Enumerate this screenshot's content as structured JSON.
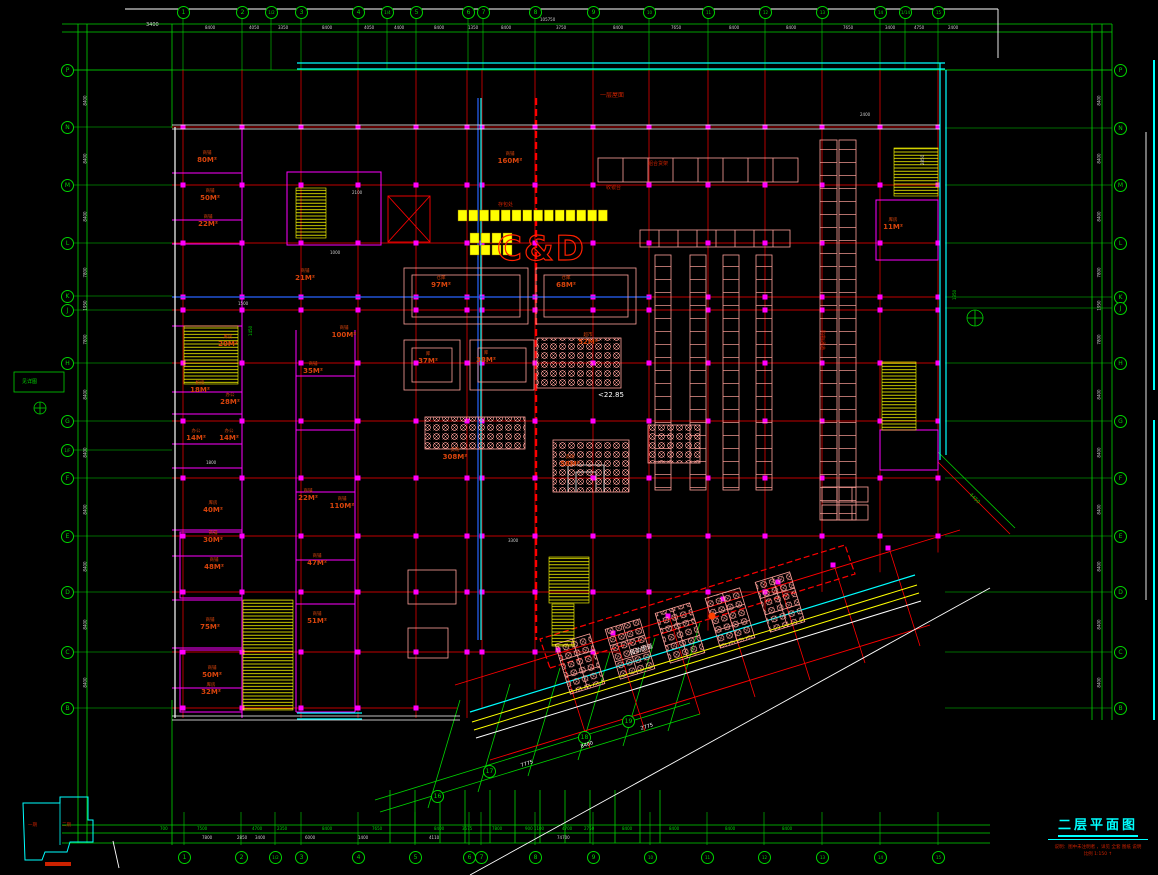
{
  "sheet": {
    "title": "二层平面图",
    "note_line1": "说明：图中未注明者 ，详见 全套 图纸 说明",
    "note_line2": "比例 1:150 ↑"
  },
  "key_plan": {
    "label_left": "一期",
    "label_right": "二期"
  },
  "logo": {
    "text": "C&D"
  },
  "colors": {
    "accent_green": "#00d400",
    "grid_red": "#ff0000",
    "wall_cyan": "#00ffff",
    "room_text": "#d8440c",
    "fixture_pink": "#ffa099",
    "stair_yellow": "#ffff00",
    "partition_magenta": "#ff00ff",
    "duct_blue": "#2864ff"
  },
  "axes": {
    "top": [
      {
        "l": "1",
        "x": 183
      },
      {
        "l": "2",
        "x": 242
      },
      {
        "l": "1/2",
        "x": 271
      },
      {
        "l": "3",
        "x": 301
      },
      {
        "l": "4",
        "x": 358
      },
      {
        "l": "1/4",
        "x": 387
      },
      {
        "l": "5",
        "x": 416
      },
      {
        "l": "6",
        "x": 468
      },
      {
        "l": "7",
        "x": 483
      },
      {
        "l": "8",
        "x": 535
      },
      {
        "l": "9",
        "x": 593
      },
      {
        "l": "10",
        "x": 649
      },
      {
        "l": "11",
        "x": 708
      },
      {
        "l": "12",
        "x": 765
      },
      {
        "l": "13",
        "x": 822
      },
      {
        "l": "14",
        "x": 880
      },
      {
        "l": "1/14",
        "x": 905
      },
      {
        "l": "15",
        "x": 938
      }
    ],
    "bottom": [
      {
        "l": "1",
        "x": 184
      },
      {
        "l": "2",
        "x": 241
      },
      {
        "l": "1/2",
        "x": 275
      },
      {
        "l": "3",
        "x": 301
      },
      {
        "l": "4",
        "x": 358
      },
      {
        "l": "5",
        "x": 415
      },
      {
        "l": "6",
        "x": 469
      },
      {
        "l": "7",
        "x": 481
      },
      {
        "l": "8",
        "x": 535
      },
      {
        "l": "9",
        "x": 593
      },
      {
        "l": "10",
        "x": 650
      },
      {
        "l": "11",
        "x": 707
      },
      {
        "l": "12",
        "x": 764
      },
      {
        "l": "13",
        "x": 822
      },
      {
        "l": "14",
        "x": 880
      },
      {
        "l": "15",
        "x": 938
      }
    ],
    "left": [
      {
        "l": "P",
        "y": 70
      },
      {
        "l": "N",
        "y": 127
      },
      {
        "l": "M",
        "y": 185
      },
      {
        "l": "L",
        "y": 243
      },
      {
        "l": "K",
        "y": 296
      },
      {
        "l": "J",
        "y": 310
      },
      {
        "l": "H",
        "y": 363
      },
      {
        "l": "G",
        "y": 421
      },
      {
        "l": "1/F",
        "y": 450
      },
      {
        "l": "F",
        "y": 478
      },
      {
        "l": "E",
        "y": 536
      },
      {
        "l": "D",
        "y": 592
      },
      {
        "l": "C",
        "y": 652
      },
      {
        "l": "B",
        "y": 708
      }
    ],
    "right": [
      {
        "l": "P",
        "y": 70
      },
      {
        "l": "N",
        "y": 128
      },
      {
        "l": "M",
        "y": 185
      },
      {
        "l": "L",
        "y": 243
      },
      {
        "l": "K",
        "y": 297
      },
      {
        "l": "J",
        "y": 308
      },
      {
        "l": "H",
        "y": 363
      },
      {
        "l": "G",
        "y": 421
      },
      {
        "l": "F",
        "y": 478
      },
      {
        "l": "E",
        "y": 536
      },
      {
        "l": "D",
        "y": 592
      },
      {
        "l": "C",
        "y": 652
      },
      {
        "l": "B",
        "y": 708
      }
    ],
    "wing": [
      {
        "l": "16",
        "x": 437,
        "y": 796
      },
      {
        "l": "17",
        "x": 489,
        "y": 771
      },
      {
        "l": "18",
        "x": 584,
        "y": 737
      },
      {
        "l": "19",
        "x": 628,
        "y": 721
      }
    ]
  },
  "dims": {
    "top_total": {
      "t": "105750",
      "x": 552,
      "y": 17
    },
    "top": [
      {
        "t": "8400",
        "x": 213
      },
      {
        "t": "4050",
        "x": 257
      },
      {
        "t": "3350",
        "x": 286
      },
      {
        "t": "8400",
        "x": 330
      },
      {
        "t": "4050",
        "x": 372
      },
      {
        "t": "4400",
        "x": 402
      },
      {
        "t": "8400",
        "x": 442
      },
      {
        "t": "1350",
        "x": 476
      },
      {
        "t": "8400",
        "x": 509
      },
      {
        "t": "3750",
        "x": 564
      },
      {
        "t": "8400",
        "x": 621
      },
      {
        "t": "7650",
        "x": 679
      },
      {
        "t": "8400",
        "x": 737
      },
      {
        "t": "8400",
        "x": 794
      },
      {
        "t": "7650",
        "x": 851
      },
      {
        "t": "3400",
        "x": 893
      },
      {
        "t": "4750",
        "x": 922
      },
      {
        "t": "2400",
        "x": 956
      }
    ],
    "bottom_row1": [
      {
        "t": "700",
        "x": 168
      },
      {
        "t": "7500",
        "x": 205
      },
      {
        "t": "4700",
        "x": 260
      },
      {
        "t": "2350",
        "x": 285
      },
      {
        "t": "8400",
        "x": 330
      },
      {
        "t": "7650",
        "x": 380
      },
      {
        "t": "8400",
        "x": 442
      },
      {
        "t": "3575",
        "x": 470
      },
      {
        "t": "7800",
        "x": 500
      },
      {
        "t": "900 1100",
        "x": 533
      },
      {
        "t": "4700",
        "x": 570
      },
      {
        "t": "2750",
        "x": 592
      },
      {
        "t": "8400",
        "x": 630
      },
      {
        "t": "8400",
        "x": 677
      },
      {
        "t": "8400",
        "x": 733
      },
      {
        "t": "8400",
        "x": 790
      }
    ],
    "bottom_row2": [
      {
        "t": "7800",
        "x": 210
      },
      {
        "t": "2850",
        "x": 245
      },
      {
        "t": "3400",
        "x": 263
      },
      {
        "t": "6000",
        "x": 313
      },
      {
        "t": "1400",
        "x": 366
      },
      {
        "t": "4110",
        "x": 437
      },
      {
        "t": "74700",
        "x": 565
      }
    ],
    "left": [
      {
        "t": "8400",
        "y": 98
      },
      {
        "t": "8400",
        "y": 156
      },
      {
        "t": "8400",
        "y": 214
      },
      {
        "t": "7800",
        "y": 270
      },
      {
        "t": "1950",
        "y": 303
      },
      {
        "t": "7800",
        "y": 337
      },
      {
        "t": "8400",
        "y": 392
      },
      {
        "t": "8400",
        "y": 450
      },
      {
        "t": "8400",
        "y": 507
      },
      {
        "t": "8400",
        "y": 564
      },
      {
        "t": "8400",
        "y": 622
      },
      {
        "t": "8400",
        "y": 680
      }
    ],
    "right": [
      {
        "t": "8400",
        "y": 98
      },
      {
        "t": "8400",
        "y": 156
      },
      {
        "t": "8400",
        "y": 214
      },
      {
        "t": "7800",
        "y": 270
      },
      {
        "t": "1950",
        "y": 303
      },
      {
        "t": "7800",
        "y": 337
      },
      {
        "t": "8400",
        "y": 392
      },
      {
        "t": "8400",
        "y": 450
      },
      {
        "t": "8400",
        "y": 507
      },
      {
        "t": "8400",
        "y": 564
      },
      {
        "t": "8400",
        "y": 622
      },
      {
        "t": "8400",
        "y": 680
      }
    ]
  },
  "rooms": [
    {
      "name": "商铺",
      "area": "80M²",
      "x": 207,
      "y": 160
    },
    {
      "name": "商铺",
      "area": "50M²",
      "x": 210,
      "y": 198
    },
    {
      "name": "商铺",
      "area": "22M²",
      "x": 208,
      "y": 224
    },
    {
      "name": "商铺",
      "area": "21M²",
      "x": 305,
      "y": 278
    },
    {
      "name": "商铺",
      "area": "100M²",
      "x": 344,
      "y": 335
    },
    {
      "name": "库房",
      "area": "20M²",
      "x": 228,
      "y": 344
    },
    {
      "name": "机房",
      "area": "18M²",
      "x": 200,
      "y": 390
    },
    {
      "name": "办公",
      "area": "28M²",
      "x": 230,
      "y": 402
    },
    {
      "name": "办公",
      "area": "14M²",
      "x": 196,
      "y": 438
    },
    {
      "name": "办公",
      "area": "14M²",
      "x": 229,
      "y": 438
    },
    {
      "name": "商铺",
      "area": "35M²",
      "x": 313,
      "y": 371
    },
    {
      "name": "库房",
      "area": "40M²",
      "x": 213,
      "y": 510
    },
    {
      "name": "商铺",
      "area": "30M²",
      "x": 213,
      "y": 540
    },
    {
      "name": "商铺",
      "area": "48M²",
      "x": 214,
      "y": 567
    },
    {
      "name": "商铺",
      "area": "75M²",
      "x": 210,
      "y": 627
    },
    {
      "name": "商铺",
      "area": "50M²",
      "x": 212,
      "y": 675
    },
    {
      "name": "库房",
      "area": "32M²",
      "x": 211,
      "y": 692
    },
    {
      "name": "商铺",
      "area": "110M²",
      "x": 342,
      "y": 506
    },
    {
      "name": "商铺",
      "area": "22M²",
      "x": 308,
      "y": 498
    },
    {
      "name": "商铺",
      "area": "47M²",
      "x": 317,
      "y": 563
    },
    {
      "name": "商铺",
      "area": "51M²",
      "x": 317,
      "y": 621
    },
    {
      "name": "仓库",
      "area": "97M²",
      "x": 441,
      "y": 285
    },
    {
      "name": "仓库",
      "area": "68M²",
      "x": 566,
      "y": 285
    },
    {
      "name": "库",
      "area": "37M²",
      "x": 428,
      "y": 361
    },
    {
      "name": "库",
      "area": "38M²",
      "x": 486,
      "y": 360
    },
    {
      "name": "超市",
      "area": "52M²",
      "x": 588,
      "y": 342
    },
    {
      "name": "卖场",
      "area": "308M²",
      "x": 455,
      "y": 457
    },
    {
      "name": "卖场",
      "area": "58M²",
      "x": 570,
      "y": 464
    },
    {
      "name": "商铺",
      "area": "160M²",
      "x": 510,
      "y": 161
    },
    {
      "name": "库房",
      "area": "11M²",
      "x": 893,
      "y": 227
    }
  ],
  "annotations": [
    {
      "t": "<22.85",
      "x": 598,
      "y": 391,
      "c": "#ffffff",
      "s": 7
    },
    {
      "t": "一层屋面",
      "x": 600,
      "y": 90,
      "c": "#cc2200",
      "s": 6
    },
    {
      "t": "存包处",
      "x": 498,
      "y": 201,
      "c": "#cc2200",
      "s": 5
    },
    {
      "t": "组合货架",
      "x": 648,
      "y": 160,
      "c": "#cc2200",
      "s": 5
    },
    {
      "t": "收银台",
      "x": 606,
      "y": 184,
      "c": "#cc2200",
      "s": 5
    },
    {
      "t": "购物通道",
      "x": 826,
      "y": 330,
      "c": "#cc2200",
      "s": 5,
      "rot": 90
    },
    {
      "t": "自动步道",
      "x": 628,
      "y": 648,
      "c": "#ffffff",
      "s": 6,
      "rot": -17
    },
    {
      "t": "7775",
      "x": 520,
      "y": 763,
      "c": "#ffffff",
      "s": 5,
      "rot": -17
    },
    {
      "t": "8400",
      "x": 580,
      "y": 744,
      "c": "#ffffff",
      "s": 5,
      "rot": -17
    },
    {
      "t": "2775",
      "x": 640,
      "y": 726,
      "c": "#ffffff",
      "s": 5,
      "rot": -17
    },
    {
      "t": "4450",
      "x": 972,
      "y": 492,
      "c": "#00d400",
      "s": 5,
      "rot": 45
    },
    {
      "t": "3400",
      "x": 146,
      "y": 22,
      "c": "#cfcfcf",
      "s": 5
    },
    {
      "t": "2400",
      "x": 860,
      "y": 112,
      "c": "#cfcfcf",
      "s": 4
    },
    {
      "t": "见详图",
      "x": 22,
      "y": 378,
      "c": "#00d400",
      "s": 5
    },
    {
      "t": "1450",
      "x": 248,
      "y": 336,
      "c": "#00d400",
      "s": 4,
      "rot": -90
    },
    {
      "t": "2100",
      "x": 352,
      "y": 190,
      "c": "#cfcfcf",
      "s": 4
    },
    {
      "t": "1000",
      "x": 330,
      "y": 250,
      "c": "#cfcfcf",
      "s": 4
    },
    {
      "t": "1500",
      "x": 238,
      "y": 301,
      "c": "#cfcfcf",
      "s": 4
    },
    {
      "t": "1800",
      "x": 206,
      "y": 460,
      "c": "#cfcfcf",
      "s": 4
    },
    {
      "t": "3300",
      "x": 508,
      "y": 538,
      "c": "#cfcfcf",
      "s": 4
    },
    {
      "t": "2850",
      "x": 920,
      "y": 165,
      "c": "#cfcfcf",
      "s": 4,
      "rot": -90
    },
    {
      "t": "1350",
      "x": 952,
      "y": 300,
      "c": "#00d400",
      "s": 4,
      "rot": -90
    }
  ]
}
